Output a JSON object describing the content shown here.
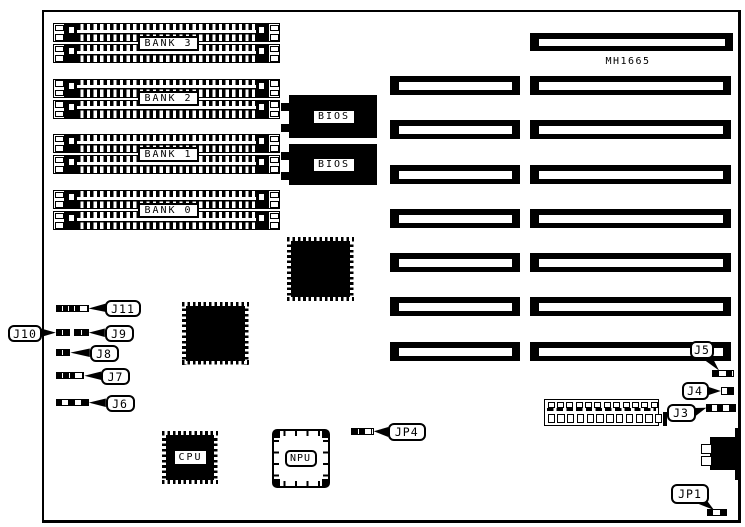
{
  "diagram": {
    "board_model": "MH1665",
    "banks": [
      {
        "label": "BANK 3"
      },
      {
        "label": "BANK 2"
      },
      {
        "label": "BANK 1"
      },
      {
        "label": "BANK 0"
      }
    ],
    "bios": [
      {
        "label": "BIOS"
      },
      {
        "label": "BIOS"
      }
    ],
    "cpu": {
      "label": "CPU"
    },
    "npu": {
      "label": "NPU"
    },
    "jumpers": [
      {
        "id": "j11",
        "label": "J11"
      },
      {
        "id": "j10",
        "label": "J10"
      },
      {
        "id": "j9",
        "label": "J9"
      },
      {
        "id": "j8",
        "label": "J8"
      },
      {
        "id": "j7",
        "label": "J7"
      },
      {
        "id": "j6",
        "label": "J6"
      },
      {
        "id": "jp4",
        "label": "JP4"
      },
      {
        "id": "j5",
        "label": "J5"
      },
      {
        "id": "j4",
        "label": "J4"
      },
      {
        "id": "j3",
        "label": "J3"
      },
      {
        "id": "jp1",
        "label": "JP1"
      }
    ],
    "colors": {
      "ink": "#000000",
      "paper": "#ffffff"
    }
  }
}
